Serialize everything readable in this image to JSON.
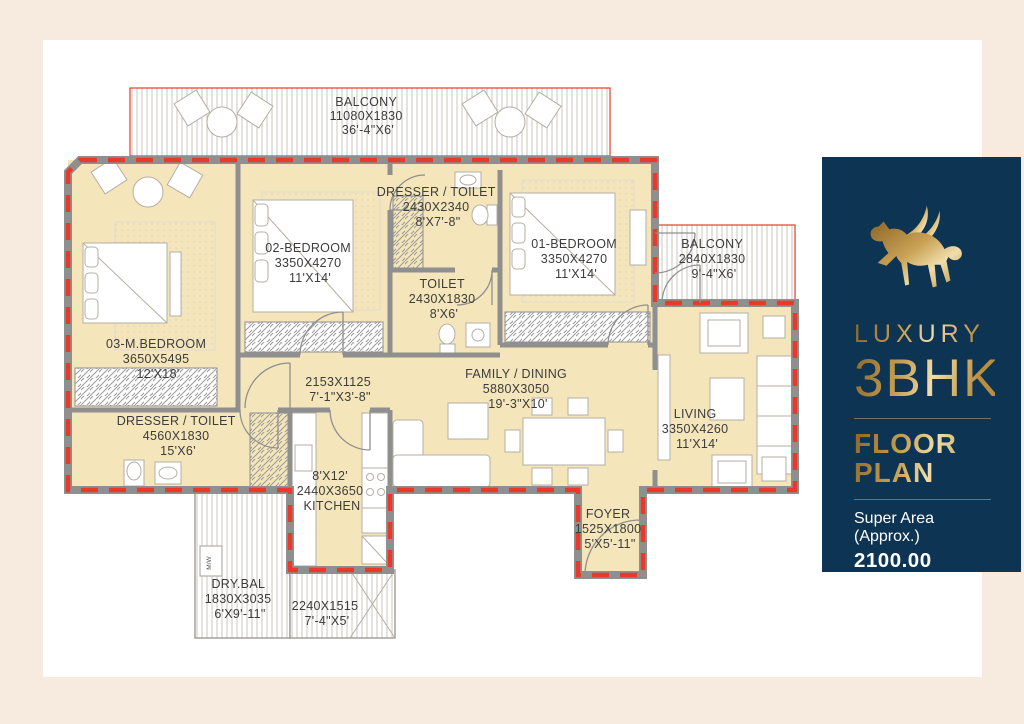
{
  "panel": {
    "brand_line": "LUXURY",
    "type_line": "3BHK",
    "floor_line1": "FLOOR",
    "floor_line2": "PLAN",
    "super_area_label": "Super Area (Approx.)",
    "super_area_value": "2100.00 SQ.FT.",
    "logo_icon": "gold-pegasus-horse",
    "colors": {
      "background": "#0e3453",
      "gold": "#caa255",
      "text": "#ffffff"
    }
  },
  "floor_plan": {
    "colors": {
      "page_background": "#f7ebe0",
      "canvas": "#ffffff",
      "room_fill": "#f4e6ba",
      "wall_gray": "#8f8f8f",
      "boundary_red": "#e8392a",
      "label_text": "#3c3c3c"
    },
    "labels": {
      "mw": "M/W"
    },
    "rooms": {
      "balcony_top": {
        "name": "BALCONY",
        "mm": "11080X1830",
        "ft": "36'-4\"X6'"
      },
      "m_bedroom": {
        "name": "03-M.BEDROOM",
        "mm": "3650X5495",
        "ft": "12'X18'"
      },
      "bedroom2": {
        "name": "02-BEDROOM",
        "mm": "3350X4270",
        "ft": "11'X14'"
      },
      "dresser_toilet_top": {
        "name": "DRESSER / TOILET",
        "mm": "2430X2340",
        "ft": "8'X7'-8\""
      },
      "toilet": {
        "name": "TOILET",
        "mm": "2430X1830",
        "ft": "8'X6'"
      },
      "bedroom1": {
        "name": "01-BEDROOM",
        "mm": "3350X4270",
        "ft": "11'X14'"
      },
      "balcony_right": {
        "name": "BALCONY",
        "mm": "2840X1830",
        "ft": "9'-4\"X6'"
      },
      "passage": {
        "mm": "2153X1125",
        "ft": "7'-1\"X3'-8\""
      },
      "family_dining": {
        "name": "FAMILY / DINING",
        "mm": "5880X3050",
        "ft": "19'-3\"X10'"
      },
      "dresser_toilet_left": {
        "name": "DRESSER / TOILET",
        "mm": "4560X1830",
        "ft": "15'X6'"
      },
      "living": {
        "name": "LIVING",
        "mm": "3350X4260",
        "ft": "11'X14'"
      },
      "kitchen": {
        "line1": "8'X12'",
        "line2": "2440X3650",
        "line3": "KITCHEN"
      },
      "foyer": {
        "name": "FOYER",
        "mm": "1525X1800",
        "ft": "5'X5'-11\""
      },
      "dry_bal": {
        "name": "DRY.BAL",
        "mm": "1830X3035",
        "ft": "6'X9'-11\""
      },
      "bottom_balcony": {
        "mm": "2240X1515",
        "ft": "7'-4\"X5'"
      }
    }
  }
}
